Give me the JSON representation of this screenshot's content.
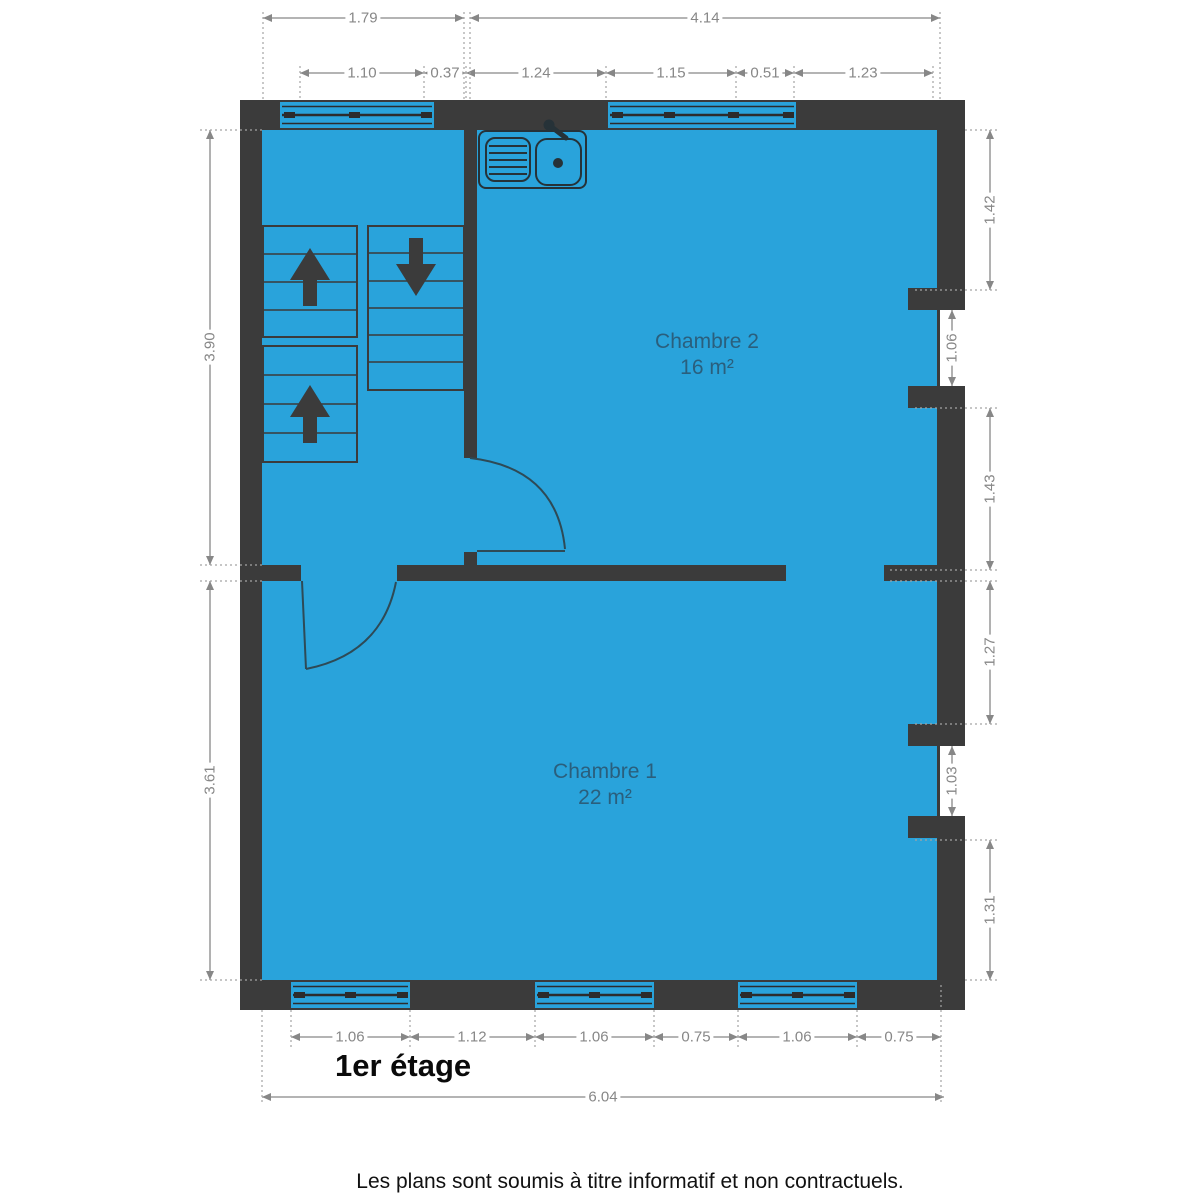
{
  "plan": {
    "title": "1er étage",
    "disclaimer": "Les plans sont soumis à titre informatif et non contractuels.",
    "rooms": [
      {
        "name": "Chambre 2",
        "area": "16 m²"
      },
      {
        "name": "Chambre 1",
        "area": "22 m²"
      }
    ],
    "colors": {
      "floor": "#29a3db",
      "wall": "#3b3b3b",
      "dimension": "#878787",
      "room_label": "#2a5f7d"
    },
    "dimensions": {
      "top_overall": [
        "1.79",
        "4.14"
      ],
      "top_detail": [
        "1.10",
        "0.37",
        "1.24",
        "1.15",
        "0.51",
        "1.23"
      ],
      "left": [
        "3.90",
        "3.61"
      ],
      "right": [
        "1.42",
        "1.43",
        "1.27",
        "1.31"
      ],
      "right_windows": [
        "1.06",
        "1.03"
      ],
      "bottom": [
        "1.06",
        "1.12",
        "1.06",
        "0.75",
        "1.06",
        "0.75"
      ],
      "bottom_overall": "6.04"
    }
  }
}
